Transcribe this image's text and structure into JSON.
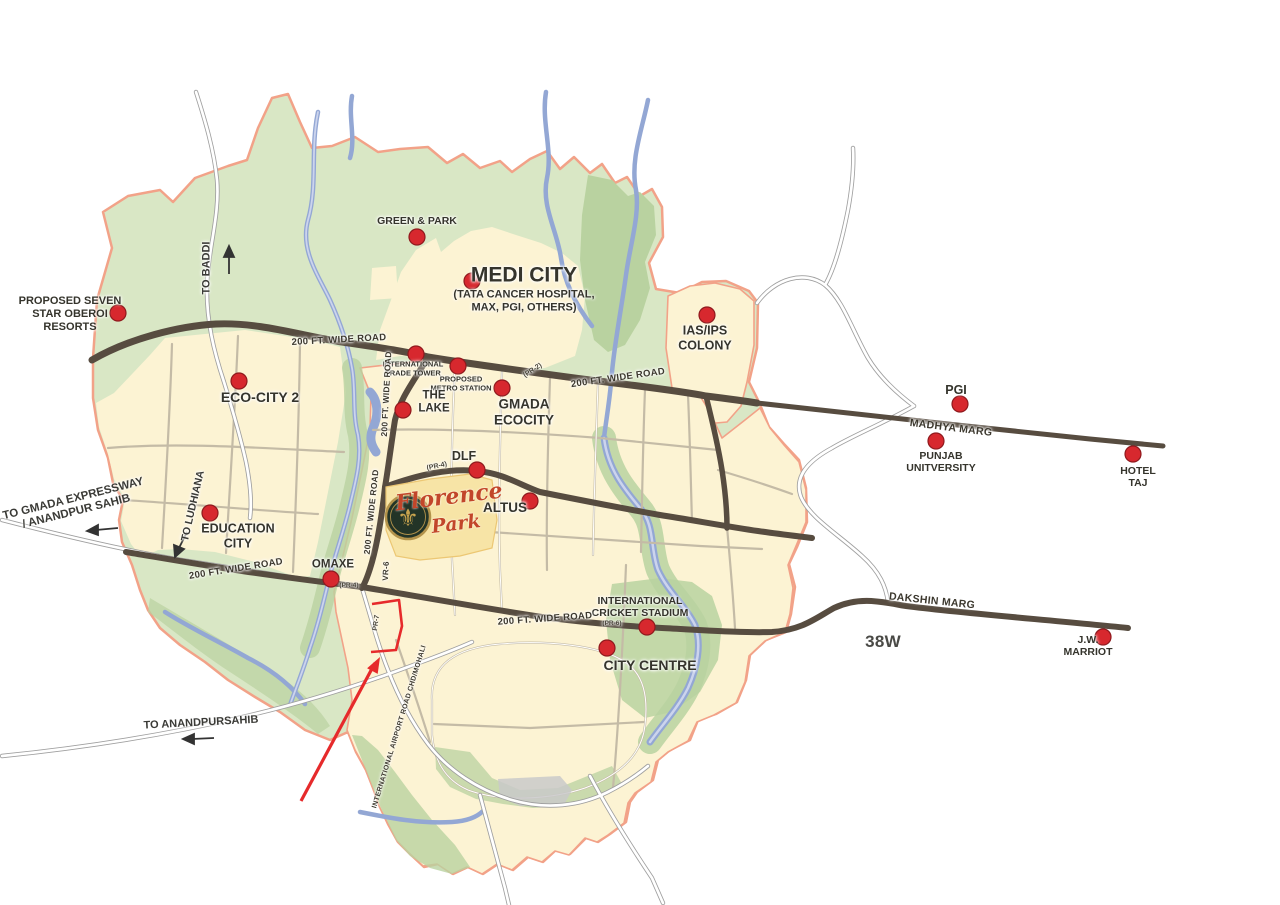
{
  "colors": {
    "background": "#ffffff",
    "land_green": "#d9e7c5",
    "dark_green": "#b9d2a0",
    "urban_cream": "#fcf3d3",
    "river_blue": "#93a7d4",
    "major_road_brown": "#574c40",
    "boundary_salmon": "#f2a288",
    "marker_red": "#d7282e",
    "highlight_red": "#e62a2b",
    "site_text_red": "#c2462a",
    "logo_gold": "#c8a44e"
  },
  "site": {
    "name_line1": "Florence",
    "name_line2": "Park",
    "logo_icon": "fleur-de-lis-icon",
    "logo_glyph": "⚜",
    "plot_road_ref": "PR-7"
  },
  "landmarks": [
    {
      "id": "proposed-seven-star-oberoi-resorts",
      "lines": [
        "PROPOSED SEVEN",
        "STAR OBEROI",
        "RESORTS"
      ],
      "x": 70,
      "y": 314,
      "size": 11,
      "dot": {
        "x": 118,
        "y": 313
      }
    },
    {
      "id": "green-and-park",
      "lines": [
        "GREEN & PARK"
      ],
      "x": 417,
      "y": 221,
      "size": 10.5,
      "dot": {
        "x": 417,
        "y": 237
      }
    },
    {
      "id": "medi-city",
      "lines": [
        "MEDI CITY"
      ],
      "x": 524,
      "y": 289,
      "size": 21,
      "sub": {
        "lines": [
          "(TATA CANCER HOSPITAL,",
          "MAX, PGI, OTHERS)"
        ],
        "size": 11
      },
      "dot": {
        "x": 472,
        "y": 281
      }
    },
    {
      "id": "international-trade-tower",
      "lines": [
        "INTERNATIONAL",
        "TRADE TOWER"
      ],
      "x": 413,
      "y": 369,
      "size": 7.5,
      "dot": {
        "x": 416,
        "y": 354
      }
    },
    {
      "id": "proposed-metro-station",
      "lines": [
        "PROPOSED",
        "METRO STATION"
      ],
      "x": 461,
      "y": 384,
      "size": 7.5,
      "dot": {
        "x": 458,
        "y": 366
      }
    },
    {
      "id": "the-lake",
      "lines": [
        "THE",
        "LAKE"
      ],
      "x": 434,
      "y": 403,
      "size": 11.5,
      "dot": {
        "x": 403,
        "y": 410
      }
    },
    {
      "id": "gmada-ecocity",
      "lines": [
        "GMADA",
        "ECOCITY"
      ],
      "x": 524,
      "y": 412,
      "size": 13.5,
      "dot": {
        "x": 502,
        "y": 388
      }
    },
    {
      "id": "eco-city-2",
      "lines": [
        "ECO-CITY 2"
      ],
      "x": 260,
      "y": 397,
      "size": 14,
      "dot": {
        "x": 239,
        "y": 381
      }
    },
    {
      "id": "ias-ips-colony",
      "lines": [
        "IAS/IPS",
        "COLONY"
      ],
      "x": 705,
      "y": 338,
      "size": 12.5,
      "dot": {
        "x": 707,
        "y": 315
      }
    },
    {
      "id": "pgi",
      "lines": [
        "PGI"
      ],
      "x": 956,
      "y": 390,
      "size": 12.5,
      "dot": {
        "x": 960,
        "y": 404
      }
    },
    {
      "id": "punjab-university",
      "lines": [
        "PUNJAB",
        "UNITVERSITY"
      ],
      "x": 941,
      "y": 462,
      "size": 10.5,
      "dot": {
        "x": 936,
        "y": 441
      }
    },
    {
      "id": "hotel-taj",
      "lines": [
        "HOTEL",
        "TAJ"
      ],
      "x": 1138,
      "y": 477,
      "size": 10.5,
      "dot": {
        "x": 1133,
        "y": 454
      }
    },
    {
      "id": "dlf",
      "lines": [
        "DLF"
      ],
      "x": 464,
      "y": 456,
      "size": 12.5,
      "dot": {
        "x": 477,
        "y": 470
      }
    },
    {
      "id": "altus",
      "lines": [
        "ALTUS"
      ],
      "x": 505,
      "y": 508,
      "size": 13.5,
      "dot": {
        "x": 530,
        "y": 501
      }
    },
    {
      "id": "education-city",
      "lines": [
        "EDUCATION",
        "CITY"
      ],
      "x": 238,
      "y": 536,
      "size": 12.5,
      "dot": {
        "x": 210,
        "y": 513
      }
    },
    {
      "id": "omaxe",
      "lines": [
        "OMAXE"
      ],
      "x": 333,
      "y": 565,
      "size": 11.5,
      "dot": {
        "x": 331,
        "y": 579
      }
    },
    {
      "id": "international-cricket-stadium",
      "lines": [
        "INTERNATIONAL",
        "CRICKET STADIUM"
      ],
      "x": 640,
      "y": 607,
      "size": 10.5,
      "dot": {
        "x": 647,
        "y": 627
      }
    },
    {
      "id": "city-centre",
      "lines": [
        "CITY CENTRE"
      ],
      "x": 650,
      "y": 665,
      "size": 14,
      "dot": {
        "x": 607,
        "y": 648
      }
    },
    {
      "id": "jw-marriot",
      "lines": [
        "J.W.",
        "MARRIOT"
      ],
      "x": 1088,
      "y": 646,
      "size": 10.5,
      "dot": {
        "x": 1103,
        "y": 637
      }
    }
  ],
  "road_labels": [
    {
      "id": "200ft-wide-road-nw",
      "text": "200 FT. WIDE ROAD",
      "x": 339,
      "y": 340,
      "rot": -3,
      "size": 9.5
    },
    {
      "id": "200ft-wide-road-ne",
      "text": "200 FT. WIDE ROAD",
      "x": 618,
      "y": 378,
      "rot": -8,
      "size": 9.5
    },
    {
      "id": "200ft-wide-road-vertical-north",
      "text": "200 FT. WIDE ROAD",
      "x": 387,
      "y": 394,
      "rot": -87,
      "size": 8.5
    },
    {
      "id": "200ft-wide-road-vertical-south",
      "text": "200 FT. WIDE ROAD",
      "x": 372,
      "y": 512,
      "rot": -84,
      "size": 8.5
    },
    {
      "id": "200ft-wide-road-sw",
      "text": "200 FT. WIDE ROAD",
      "x": 236,
      "y": 569,
      "rot": -9,
      "size": 9.5
    },
    {
      "id": "200ft-wide-road-se",
      "text": "200 FT. WIDE ROAD",
      "x": 545,
      "y": 619,
      "rot": -4,
      "size": 9.5
    },
    {
      "id": "madhya-marg",
      "text": "MADHYA MARG",
      "x": 951,
      "y": 428,
      "rot": 7,
      "size": 10.5
    },
    {
      "id": "dakshin-marg",
      "text": "DAKSHIN MARG",
      "x": 932,
      "y": 601,
      "rot": 6,
      "size": 10.5
    },
    {
      "id": "vr-6",
      "text": "VR-6",
      "x": 386,
      "y": 571,
      "rot": -87,
      "size": 8
    },
    {
      "id": "international-airport-road",
      "text": "INTERNATIONAL AIRPORT ROAD CHD/MOHALI",
      "x": 400,
      "y": 727,
      "rot": -73,
      "size": 7
    },
    {
      "id": "sector-38w",
      "text": "38W",
      "x": 883,
      "y": 642,
      "rot": 0,
      "size": 17,
      "color": "#4a4a46"
    }
  ],
  "route_refs": [
    {
      "id": "pr-2",
      "text": "(PR-2)",
      "x": 533,
      "y": 371,
      "rot": -33,
      "size": 7
    },
    {
      "id": "pr-4-dlf",
      "text": "(PR-4)",
      "x": 437,
      "y": 467,
      "rot": -12,
      "size": 7
    },
    {
      "id": "pr-4-omaxe",
      "text": "(PR-4)",
      "x": 349,
      "y": 586,
      "rot": 0,
      "size": 6.5
    },
    {
      "id": "pr-6",
      "text": "(PR-6)",
      "x": 612,
      "y": 624,
      "rot": 0,
      "size": 6.5
    },
    {
      "id": "pr-7",
      "text": "PR-7",
      "x": 377,
      "y": 623,
      "rot": -82,
      "size": 7
    }
  ],
  "direction_labels": [
    {
      "id": "to-baddi",
      "lines": [
        "TO BADDI"
      ],
      "x": 207,
      "y": 268,
      "rot": -90,
      "size": 11
    },
    {
      "id": "to-gmada-expressway",
      "lines": [
        "TO GMADA EXPRESSWAY",
        "/ ANANDPUR SAHIB"
      ],
      "x": 75,
      "y": 506,
      "rot": -14,
      "size": 11.5
    },
    {
      "id": "to-ludhiana",
      "lines": [
        "TO LUDHIANA"
      ],
      "x": 193,
      "y": 506,
      "rot": -77,
      "size": 10.5
    },
    {
      "id": "to-anandpursahib",
      "lines": [
        "TO ANANDPURSAHIB"
      ],
      "x": 201,
      "y": 723,
      "rot": -3,
      "size": 11
    }
  ]
}
